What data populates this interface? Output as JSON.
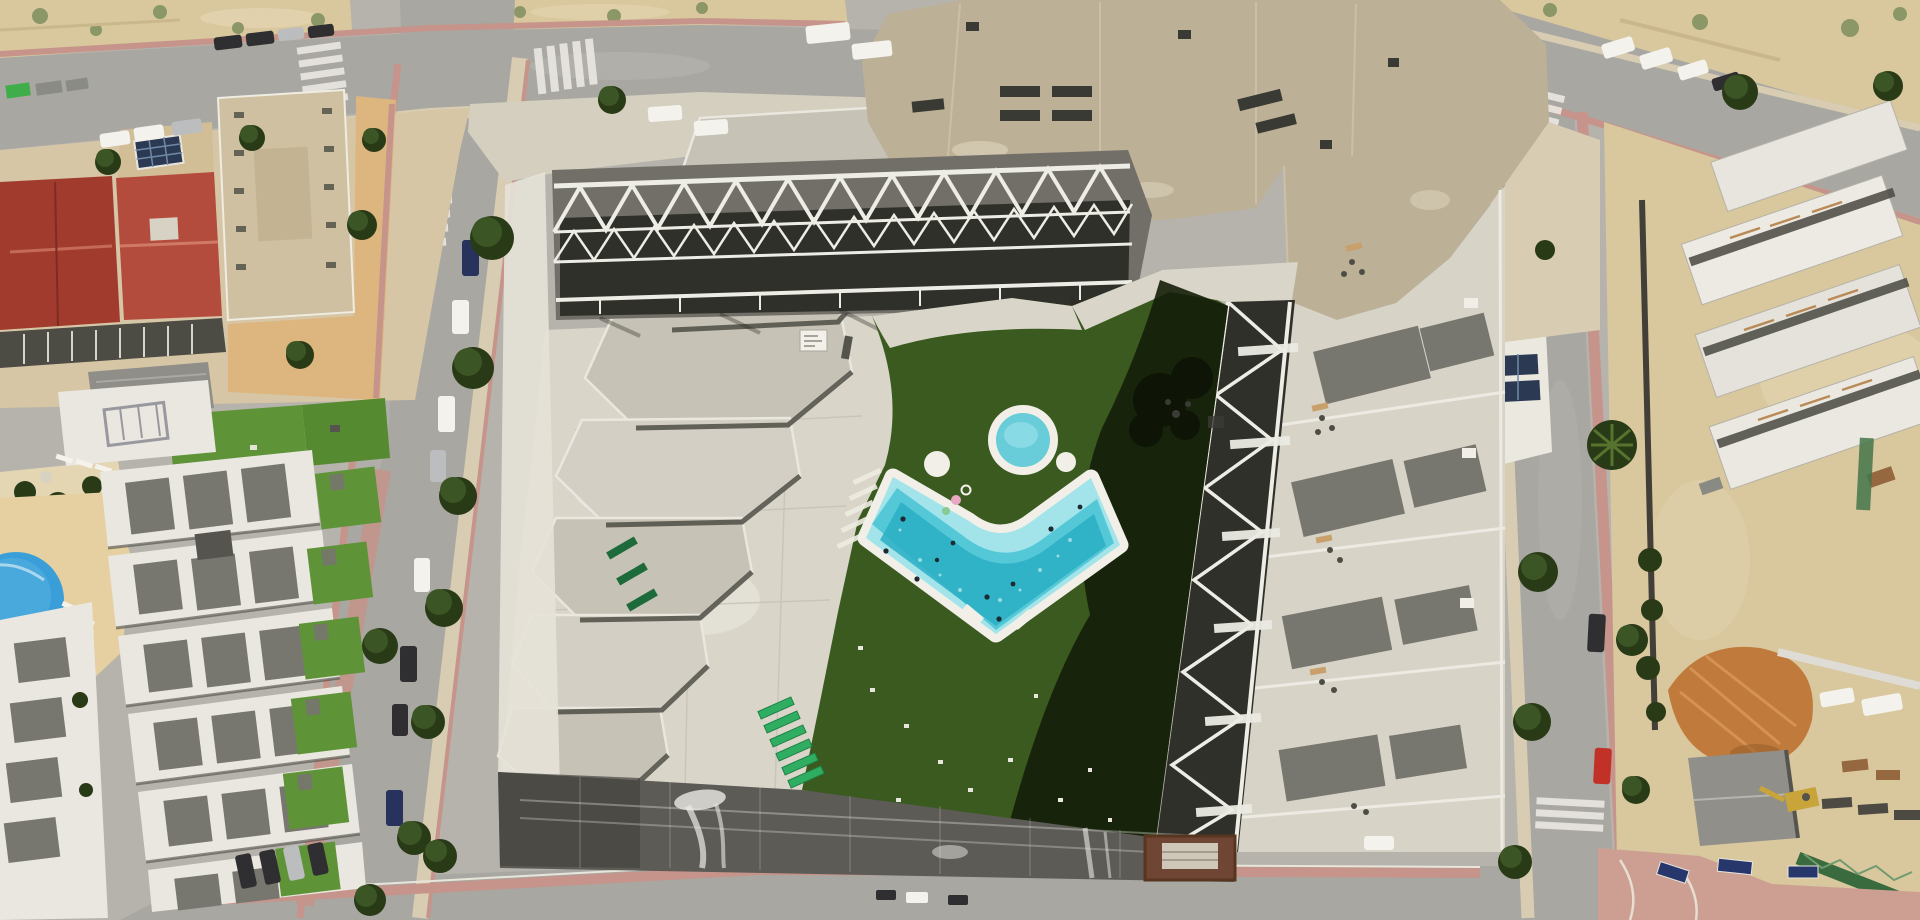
{
  "meta": {
    "type": "aerial-drone-photograph",
    "description": "Top-down aerial photo of a new-build apartment complex with a chevron-shaped turquoise pool, round kids pool, artificial turf courtyard, zig-zag white balcony trusses, beige faceted roofs, surrounding streets with parked cars, older red-roofed buildings and white townhouses to the west, and an active construction site with orange dirt to the east."
  },
  "scene": {
    "amenities": {
      "main_pool": {
        "shape": "L-shaped chevron rotated 45deg",
        "water_zones": [
          "shallow ledge",
          "deep speckled"
        ],
        "swimmers_visible": 10,
        "floats_visible": 3,
        "deck": "white tile border"
      },
      "kids_pool": {
        "shape": "circle",
        "white_ring": true
      },
      "umbrella_bases_white_circles": 2,
      "sun_loungers_green_stack": 6,
      "sun_loungers_dark_green": 3,
      "courtyard_lawn": "artificial turf, right half in deep building shadow with tree-shadow blob",
      "plaza": "pale concrete with paint patches and small white sign board"
    },
    "buildings": {
      "main_complex": [
        "large beige faceted roof with dark vents",
        "stepped gray hexagonal roof cascade on west wing",
        "white zig-zag space-truss balconies on north and east courtyard sides",
        "east wing terraces with gray roof panels and furniture",
        "white roof terrace with 2 solar panels at northeast"
      ],
      "west_blocks": [
        "two red clay-tile hip roofs",
        "beige mid-rise with window rows",
        "dark south balcony strip",
        "gray tarp on ground",
        "orange-tan courtyard with trees"
      ],
      "townhouses_southwest": [
        "6 white rows with gray roof panels",
        "bright green lawn strips",
        "sandy deck with round blue pool and white loungers",
        "rock-and-hedge garden"
      ],
      "construction_site_east": [
        "white concrete slab decks with timber beams",
        "orange excavated dirt mound",
        "gray shed roof",
        "yellow mini-digger",
        "green crane truss",
        "stacked materials",
        "blue site sign boards on pink corner plaza"
      ]
    },
    "ground": {
      "dark_area_south": "fresh asphalt / waterproofed deck with white paint streaks and faint joint grid",
      "streets": [
        "top street with parallel-parked cars",
        "left street sloping with street trees",
        "right street with crosswalks",
        "bottom street",
        "top-right street by sandy hillside"
      ],
      "crosswalks_visible": 5,
      "sidewalks": "salmon-pink tile edges and tan pavements",
      "vacant_lots": "pale sand with scrub bushes (top-left and top-right hillside)"
    },
    "vehicles": {
      "cars_top_street": 9,
      "vans_white_top": 2,
      "cars_left_street": 8,
      "cars_bottom_left_cluster": 4,
      "cars_right_street": [
        "black",
        "red"
      ],
      "cars_top_right": 4,
      "vans_construction": 2,
      "small_vehicles_bottom": 3
    },
    "vegetation": {
      "street_trees": 16,
      "scrub_bushes": 12,
      "hedge_garden_blobs": 6
    }
  },
  "palette": {
    "base": "#b6b3ac",
    "road": "#a8a7a2",
    "road_light": "#bab8b2",
    "sand": "#d9c79d",
    "sand_light": "#e4d6b3",
    "scrub": "#8c9768",
    "sidewalk_tan": "#d8cdb3",
    "sidewalk_pink": "#c6948a",
    "concrete": "#d9d5c9",
    "concrete_light": "#eae8df",
    "roof_beige": "#bcb096",
    "cascade": "#c7c2b6",
    "cascade_light": "#d3cfc4",
    "parapet": "#f1efe8",
    "truss_band": "#716f68",
    "truss_dark": "#30302a",
    "truss_white": "#edece5",
    "turf": "#3b5a20",
    "turf_bright": "#5f9338",
    "turf_dark": "#141e09",
    "deck": "#f1efe7",
    "pool_shallow": "#a2e4ea",
    "pool_mid": "#55c8d8",
    "pool_deep": "#2aaec4",
    "kids_water": "#68ccd9",
    "small_pool": "#3a9fd8",
    "red_roof": "#a13b2e",
    "red_roof_light": "#b44c3d",
    "beige_bldg": "#cec0a1",
    "white_bldg": "#e9e7df",
    "gray_panel": "#77766f",
    "facade_dark": "#4c4b44",
    "dark_asphalt": "#5c5b56",
    "paint": "#eceae4",
    "tree": "#3c5525",
    "tree_dark": "#293a17",
    "tree_light": "#57742f",
    "car_white": "#f3f2ed",
    "car_dark": "#2f2f31",
    "car_silver": "#bcbdbf",
    "car_navy": "#27335c",
    "car_red": "#c23127",
    "lounger": "#2fae62",
    "lounger_dark": "#1d6b3b",
    "dirt": "#c07a3c",
    "dirt_light": "#d89558",
    "shed": "#908f89",
    "crane": "#3a6b3e",
    "wall_brown": "#6f4534",
    "sign_blue": "#27376b",
    "solar": "#2b3a52",
    "tarp": "#8f8e88",
    "yard_orange": "#ddb57e",
    "vent_dark": "#3a3a34",
    "shadow": "#23221c"
  }
}
